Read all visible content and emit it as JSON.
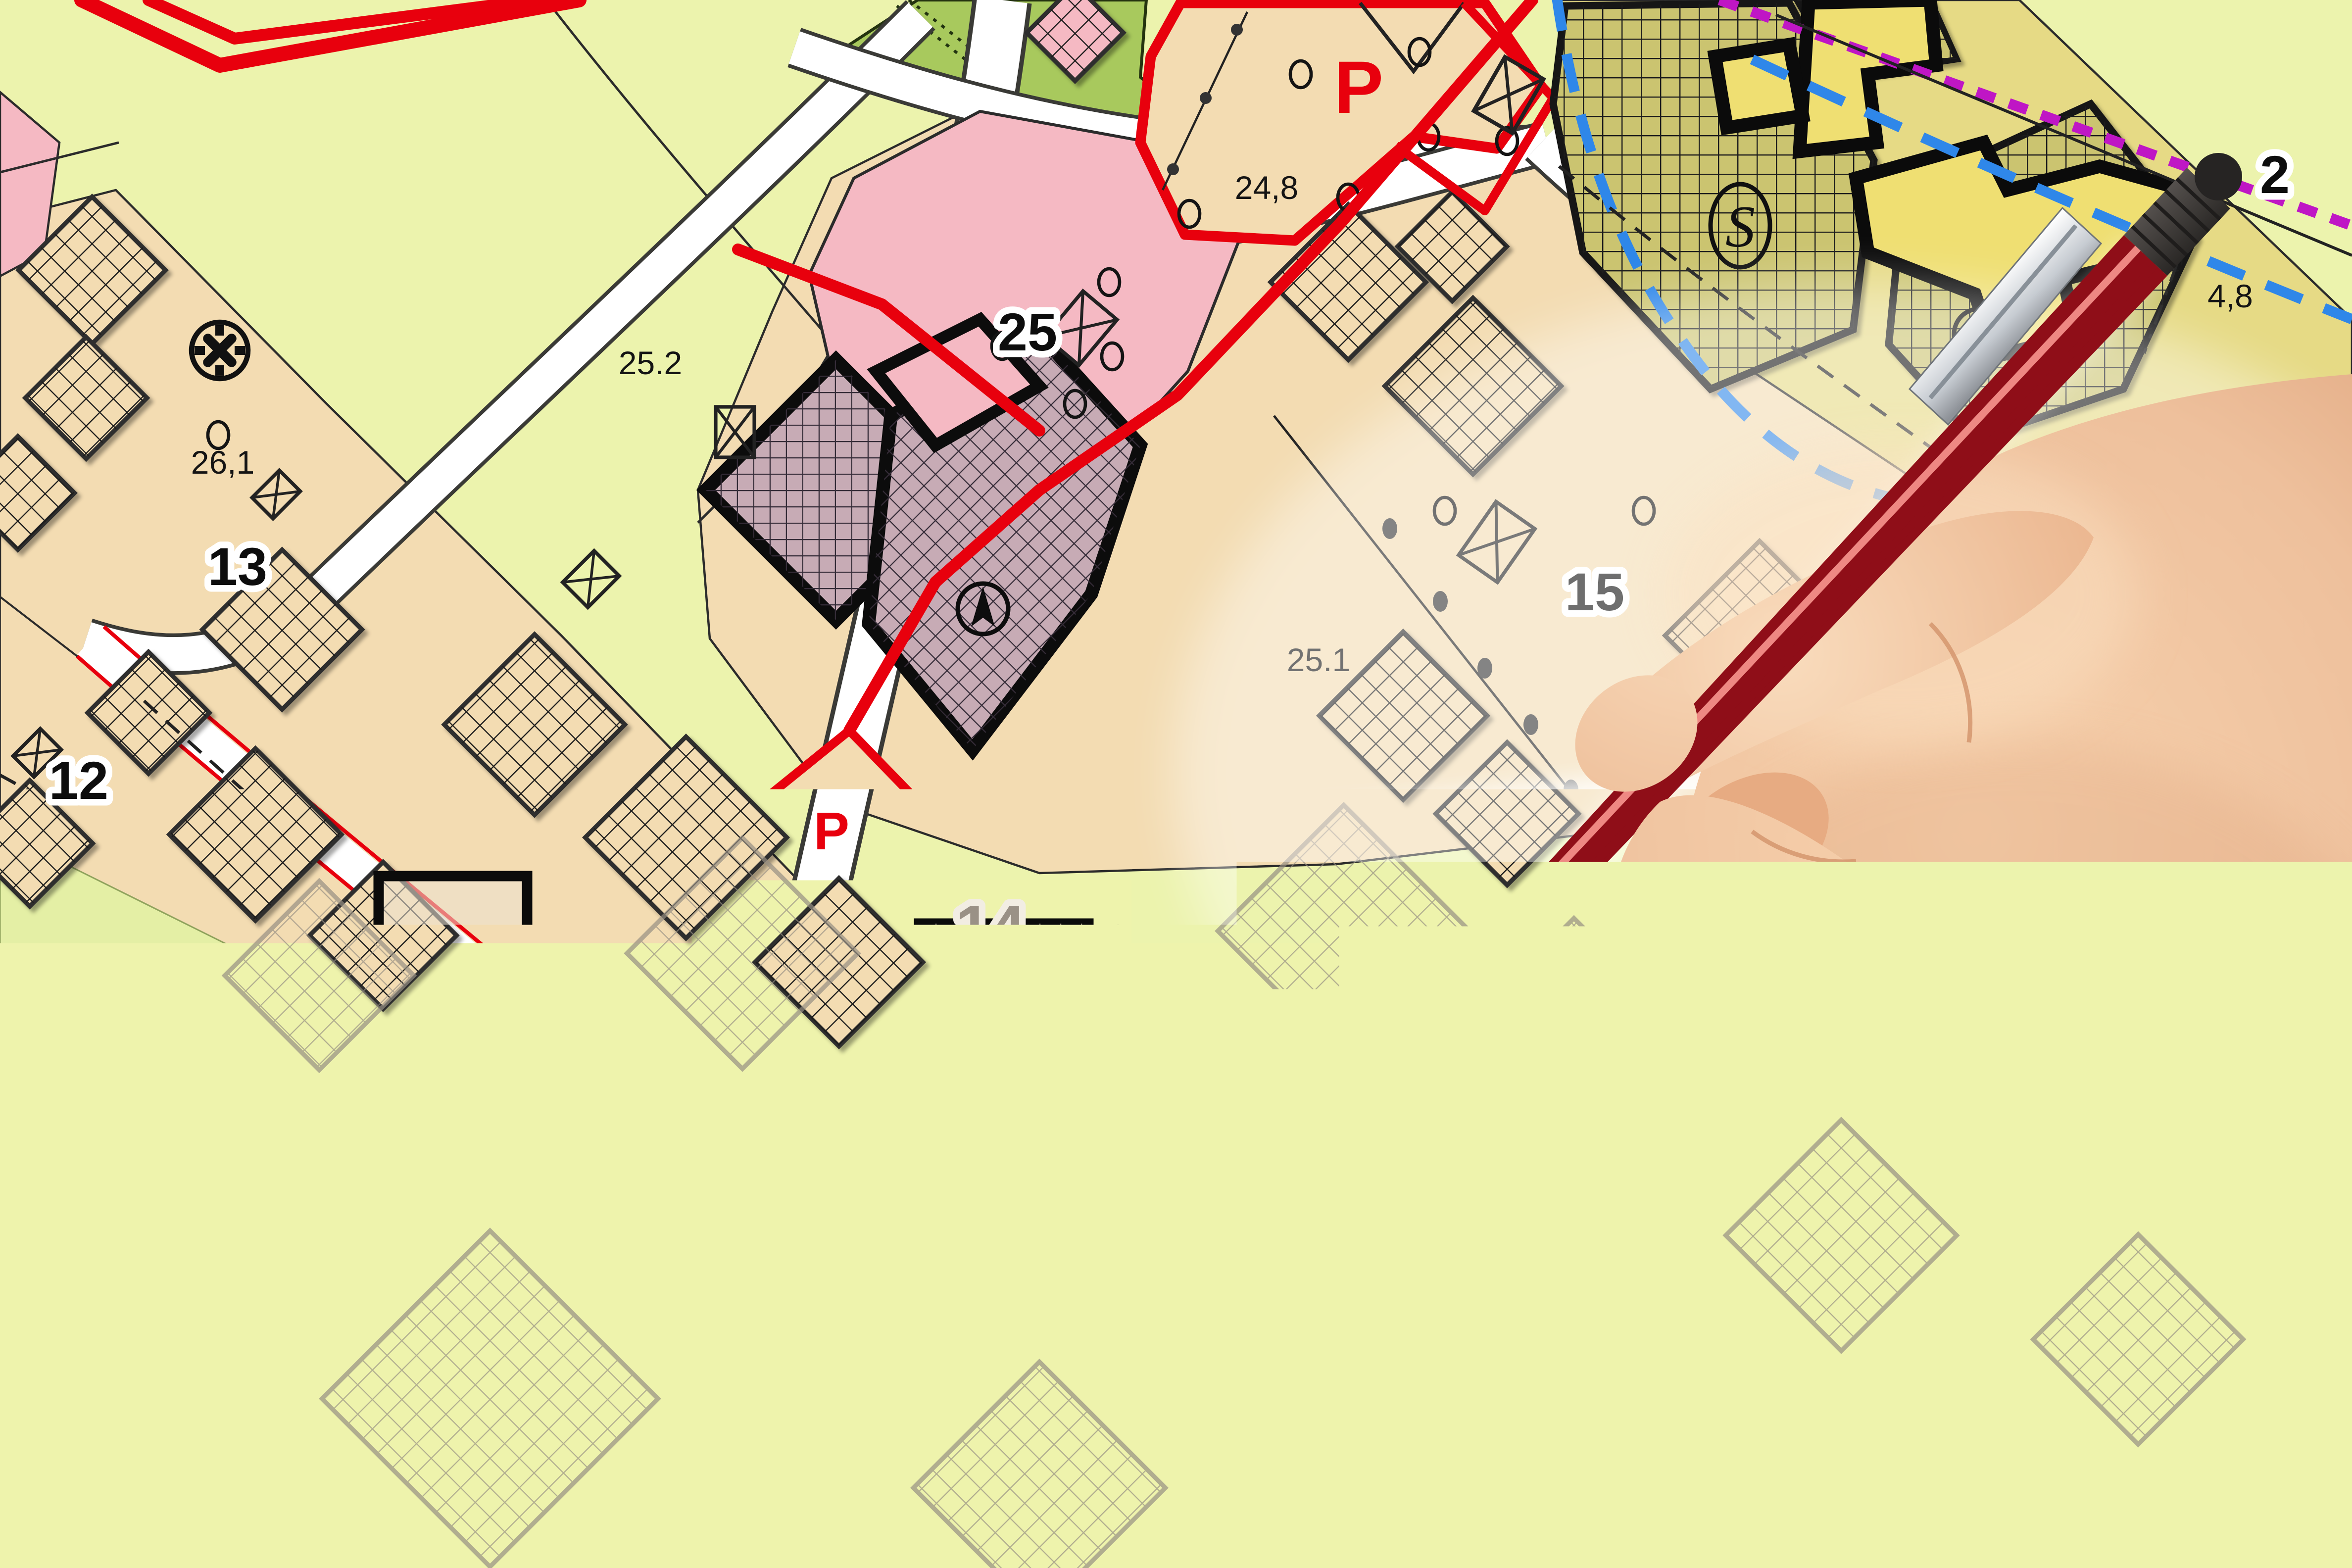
{
  "meta": {
    "scene": "cadastral-zoning-map-with-hand-holding-red-pencil",
    "style": "photo collage: city master plan sheet blending into sketched future-city drawing, human hand with red clutch pencil entering from the right"
  },
  "palette": {
    "light_green": "#ecf3ad",
    "dark_green": "#a8c95d",
    "tan": "#f3dcb2",
    "pink": "#f5b9c3",
    "plum": "#c7abb5",
    "olive": "#cbc46f",
    "yellow_building": "#efdf72",
    "red_line": "#e8000d",
    "blue_dash": "#2f87e9",
    "magenta_dots": "#bf16c5",
    "road_white": "#ffffff",
    "outline_black": "#141414",
    "sketch_base": "#e8ddcc",
    "sketch_gray": "#9a9186",
    "sketch_green": "#cdd1a3",
    "pen_red": "#c8242e",
    "pen_dark": "#37342f",
    "metal": "#cdd1d6",
    "skin": "#eec09c"
  },
  "labels": [
    {
      "name": "parcel-25-2",
      "text": "25.2"
    },
    {
      "name": "parcel-26-1",
      "text": "26,1"
    },
    {
      "name": "block-13",
      "text": "13"
    },
    {
      "name": "block-12",
      "text": "12"
    },
    {
      "name": "parcel-25-5",
      "text": "25,5"
    },
    {
      "name": "block-25",
      "text": "25"
    },
    {
      "name": "parking-large",
      "text": "P"
    },
    {
      "name": "elevation-24-8",
      "text": "24,8"
    },
    {
      "name": "parking-small",
      "text": "P"
    },
    {
      "name": "zone-s",
      "text": "S"
    },
    {
      "name": "block-15",
      "text": "15"
    },
    {
      "name": "parcel-25-1",
      "text": "25.1"
    },
    {
      "name": "block-2",
      "text": "2"
    },
    {
      "name": "elevation-4-8",
      "text": "4,8"
    },
    {
      "name": "sketch-block-14",
      "text": "14"
    },
    {
      "name": "sketch-parcel-25-3",
      "text": "25.3"
    },
    {
      "name": "sketch-block-16",
      "text": "16"
    },
    {
      "name": "sketch-block-18",
      "text": "18"
    },
    {
      "name": "sketch-parcel-24-1",
      "text": "24.1"
    }
  ],
  "icons": {
    "survey_marker": "circle-with-x-and-ticks",
    "north_arrow": "compass-needle-in-circle",
    "tree": "tree-in-ellipse",
    "plot_symbol": "rectangle-with-diagonals",
    "boundary_blue": "dashed-line",
    "boundary_magenta": "dotted-line",
    "hand": "right-hand-holding-pencil",
    "pencil": "red-clutch-pencil-black-tip-metal-clip"
  }
}
